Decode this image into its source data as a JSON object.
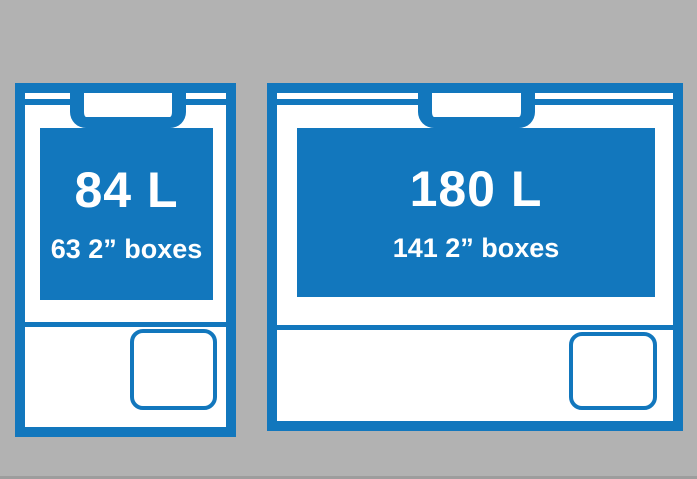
{
  "colors": {
    "background": "#b2b2b2",
    "accent-blue": "#1277bd",
    "content-white": "#ffffff",
    "bottom-edge": "#9d9d9d"
  },
  "coolers": [
    {
      "name": "small-cooler",
      "capacity": "84 L",
      "boxes": "63 2” boxes"
    },
    {
      "name": "large-cooler",
      "capacity": "180 L",
      "boxes": "141 2” boxes"
    }
  ]
}
